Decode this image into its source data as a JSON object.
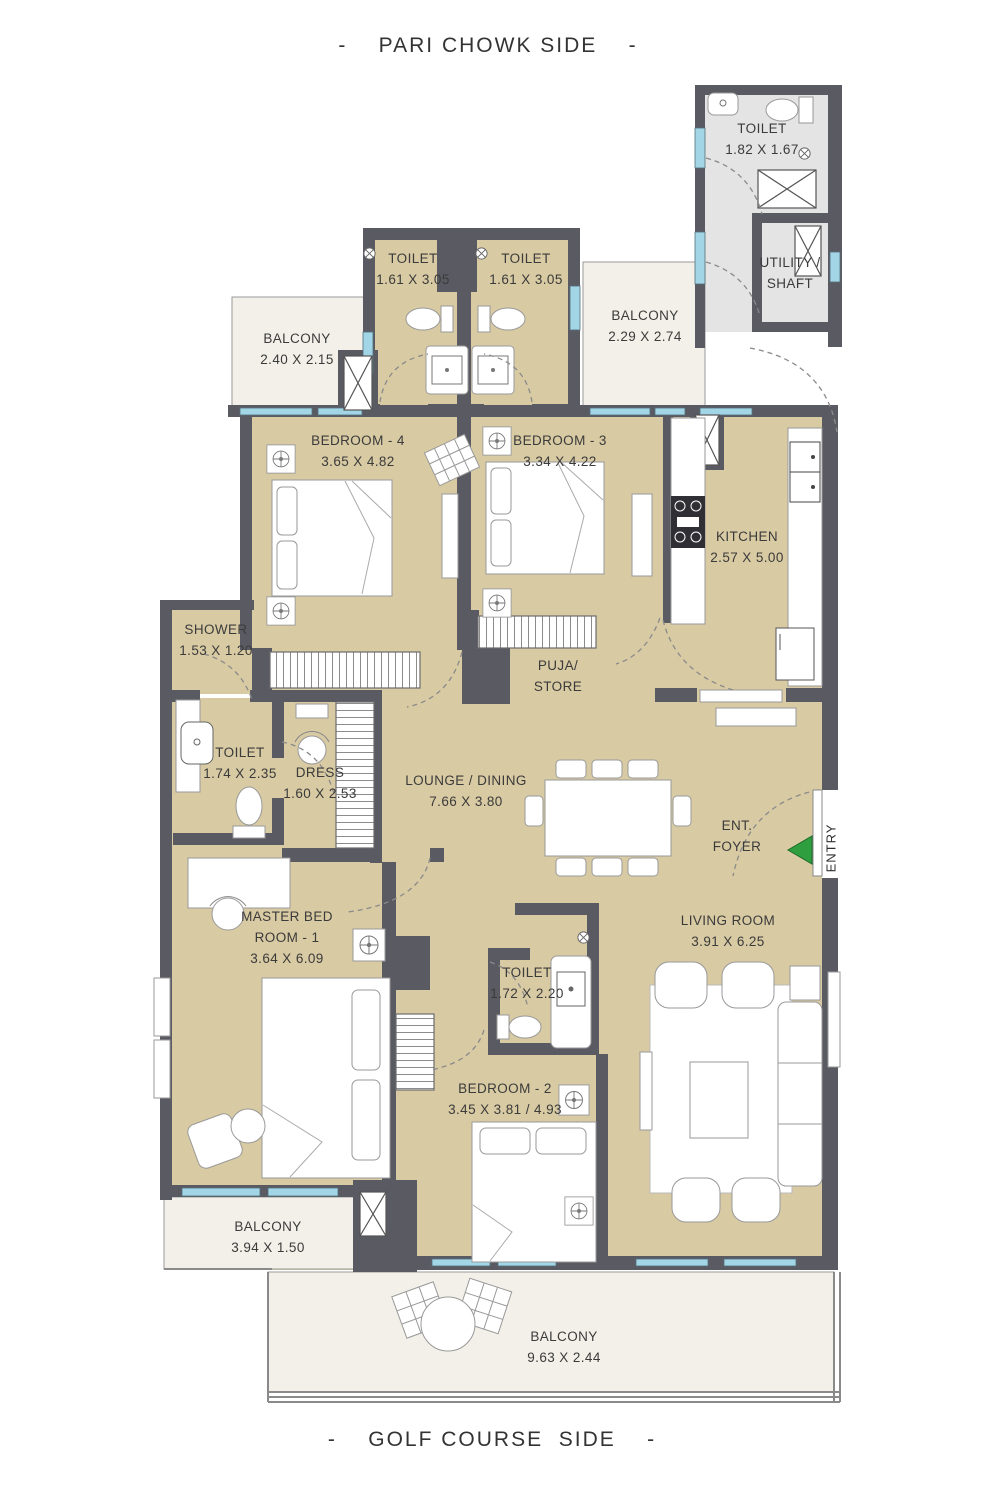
{
  "orientation": {
    "top": "-    PARI CHOWK SIDE    -",
    "bottom": "-    GOLF COURSE  SIDE    -"
  },
  "rooms": {
    "toilet_top_right": {
      "name": "TOILET",
      "dims": "1.82 X 1.67"
    },
    "utility_shaft": {
      "line1": "UTILITY /",
      "line2": "SHAFT"
    },
    "toilet_4": {
      "name": "TOILET",
      "dims": "1.61 X 3.05"
    },
    "toilet_3": {
      "name": "TOILET",
      "dims": "1.61 X 3.05"
    },
    "balcony_top_left": {
      "name": "BALCONY",
      "dims": "2.40 X 2.15"
    },
    "balcony_top_right": {
      "name": "BALCONY",
      "dims": "2.29 X 2.74"
    },
    "bedroom_4": {
      "name": "BEDROOM - 4",
      "dims": "3.65 X 4.82"
    },
    "bedroom_3": {
      "name": "BEDROOM - 3",
      "dims": "3.34 X 4.22"
    },
    "kitchen": {
      "name": "KITCHEN",
      "dims": "2.57 X 5.00"
    },
    "shower": {
      "name": "SHOWER",
      "dims": "1.53 X 1.20"
    },
    "toilet_master": {
      "name": "TOILET",
      "dims": "1.74 X 2.35"
    },
    "dress": {
      "name": "DRESS",
      "dims": "1.60 X 2.53"
    },
    "puja_store": {
      "line1": "PUJA/",
      "line2": "STORE"
    },
    "lounge_dining": {
      "name": "LOUNGE / DINING",
      "dims": "7.66 X 3.80"
    },
    "ent_foyer": {
      "line1": "ENT.",
      "line2": "FOYER"
    },
    "entry": {
      "label": "ENTRY"
    },
    "master_bedroom": {
      "line1": "MASTER BED",
      "line2": "ROOM - 1",
      "dims": "3.64 X 6.09"
    },
    "toilet_2": {
      "name": "TOILET",
      "dims": "1.72 X 2.20"
    },
    "bedroom_2": {
      "name": "BEDROOM - 2",
      "dims": "3.45 X 3.81 / 4.93"
    },
    "living_room": {
      "name": "LIVING ROOM",
      "dims": "3.91 X 6.25"
    },
    "balcony_bottom_left": {
      "name": "BALCONY",
      "dims": "3.94 X 1.50"
    },
    "balcony_bottom": {
      "name": "BALCONY",
      "dims": "9.63 X 2.44"
    }
  },
  "colors": {
    "wall": "#5a5a62",
    "floor": "#d8caa2",
    "balcony_floor": "#f2f0e8",
    "service_floor": "#e4e4e4",
    "window": "#a2d5e5",
    "entry_arrow": "#2f9e3f"
  }
}
